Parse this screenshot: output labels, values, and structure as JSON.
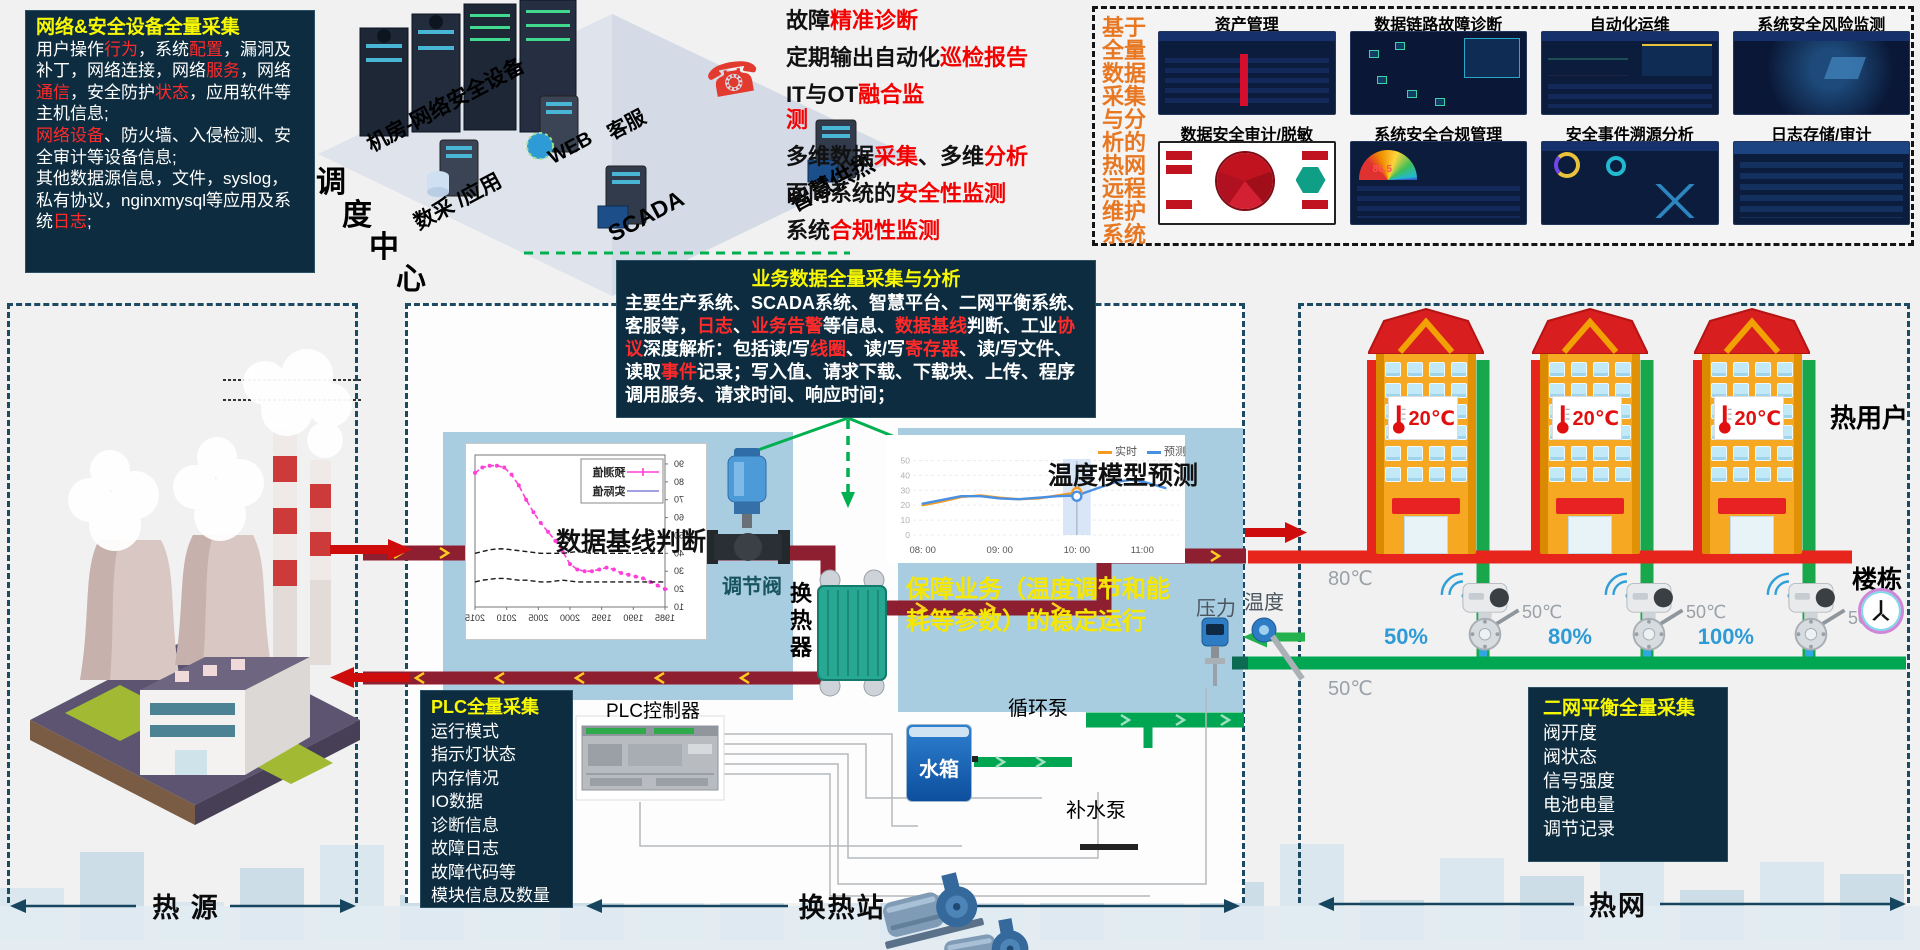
{
  "netbox": {
    "title": "网络&安全设备全量采集",
    "blocks": [
      [
        {
          "t": "用户操作"
        },
        {
          "t": "行为",
          "c": "red"
        },
        {
          "t": "，系统"
        },
        {
          "t": "配置",
          "c": "red"
        },
        {
          "t": "，漏洞及补丁，网络连接，网络"
        },
        {
          "t": "服务",
          "c": "red"
        },
        {
          "t": "，网络"
        },
        {
          "t": "通信",
          "c": "red"
        },
        {
          "t": "，安全防护"
        },
        {
          "t": "状态",
          "c": "red"
        },
        {
          "t": "，应用软件等主机信息;"
        }
      ],
      [
        {
          "t": "网络设备",
          "c": "red"
        },
        {
          "t": "、防火墙、入侵检测、安全审计等设备信息;"
        }
      ],
      [
        {
          "t": "其他数据源信息，文件，syslog，私有协议，nginxmysql等应用及系统"
        },
        {
          "t": "日志",
          "c": "red"
        },
        {
          "t": ";"
        }
      ]
    ]
  },
  "dispatch": {
    "stair": [
      "调",
      "度",
      "中",
      "心"
    ],
    "labels": {
      "machine_room": "机房-网络安全设备",
      "daq": "数采 /应用",
      "web": "WEB",
      "service": "客服",
      "scada": "SCADA",
      "smart_heating": "智慧供热"
    }
  },
  "features": {
    "items": [
      [
        {
          "t": "故障"
        },
        {
          "t": "精准诊断",
          "c": "red"
        }
      ],
      [
        {
          "t": "定期输出自动化"
        },
        {
          "t": "巡检报告",
          "c": "red"
        }
      ],
      [
        {
          "t": "IT与OT"
        },
        {
          "t": "融合监测",
          "c": "red"
        }
      ],
      [
        {
          "t": "多维数据"
        },
        {
          "t": "采集",
          "c": "red"
        },
        {
          "t": "、多维"
        },
        {
          "t": "分析",
          "c": "red"
        }
      ],
      [
        {
          "t": "面向系统的"
        },
        {
          "t": "安全性监测",
          "c": "red"
        }
      ],
      [
        {
          "t": "系统"
        },
        {
          "t": "合规性监测",
          "c": "red"
        }
      ]
    ]
  },
  "remote": {
    "vertical_lines": [
      "基于",
      "全量",
      "数据",
      "采集",
      "与分",
      "析的",
      "热网",
      "远程",
      "维护",
      "系统"
    ],
    "modules": [
      {
        "title": "资产管理"
      },
      {
        "title": "数据链路故障诊断"
      },
      {
        "title": "自动化运维"
      },
      {
        "title": "系统安全风险监测"
      },
      {
        "title": "数据安全审计/脱敏"
      },
      {
        "title": "系统安全合规管理",
        "gauge_value": "86.5"
      },
      {
        "title": "安全事件溯源分析"
      },
      {
        "title": "日志存储/审计"
      }
    ]
  },
  "bizbox": {
    "title": "业务数据全量采集与分析",
    "body": [
      {
        "t": "主要生产系统、SCADA系统、智慧平台、二网平衡系统、客服等，"
      },
      {
        "t": "日志",
        "c": "red"
      },
      {
        "t": "、"
      },
      {
        "t": "业务告警",
        "c": "red"
      },
      {
        "t": "等信息、"
      },
      {
        "t": "数据基线",
        "c": "red"
      },
      {
        "t": "判断、工业"
      },
      {
        "t": "协议",
        "c": "red"
      },
      {
        "t": "深度解析：包括读/写"
      },
      {
        "t": "线圈",
        "c": "red"
      },
      {
        "t": "、读/写"
      },
      {
        "t": "寄存器",
        "c": "red"
      },
      {
        "t": "、读/写文件、读取"
      },
      {
        "t": "事件",
        "c": "red"
      },
      {
        "t": "记录；写入值、请求下载、下载块、上传、程序调用服务、请求时间、响应时间；"
      }
    ]
  },
  "source": {
    "bottom_label": "热 源"
  },
  "station": {
    "plc_panel": {
      "title": "PLC全量采集",
      "items": [
        "运行模式",
        "指示灯状态",
        "内存情况",
        "IO数据",
        "诊断信息",
        "故障日志",
        "故障代码等",
        "模块信息及数量"
      ]
    },
    "plc_label": "PLC控制器",
    "valve_label": "调节阀",
    "exchanger_label_lines": [
      "换",
      "热",
      "器"
    ],
    "tank_label": "水箱",
    "circulation_pump_label": "循环泵",
    "makeup_pump_label": "补水泵",
    "pressure_label": "压力",
    "temperature_label": "温度",
    "assurance_lines": [
      "保障业务（温度调节和能",
      "耗等参数）的稳定运行"
    ],
    "bottom_label": "换热站"
  },
  "network": {
    "users_label": "热用户",
    "building_label": "楼栋",
    "bottom_label": "热网",
    "supply_temp": "80℃",
    "return_temp": "50℃",
    "buildings": [
      {
        "indoor_temp": "20℃"
      },
      {
        "indoor_temp": "20℃"
      },
      {
        "indoor_temp": "20℃"
      }
    ],
    "valves": [
      {
        "opening": "50%",
        "temp": "50℃"
      },
      {
        "opening": "80%",
        "temp": "50℃"
      },
      {
        "opening": "100%",
        "temp": "50℃"
      }
    ],
    "balance_panel": {
      "title": "二网平衡全量采集",
      "items": [
        "阀开度",
        "阀状态",
        "信号强度",
        "电池电量",
        "调节记录"
      ]
    }
  },
  "chart_data": [
    {
      "type": "line",
      "id": "baseline",
      "title_overlay": "数据基线判断",
      "mirrored": true,
      "legend": [
        {
          "name": "预测值",
          "color": "#ff3fd8",
          "marker": "plus"
        },
        {
          "name": "实际值",
          "color": "#8080d8",
          "marker": "none"
        }
      ],
      "x_labels": [
        "2015",
        "2010",
        "2005",
        "2000",
        "1995",
        "1990",
        "1985"
      ],
      "y_labels": [
        90,
        80,
        70,
        60,
        50,
        40,
        30,
        20,
        10
      ],
      "y_range": [
        10,
        95
      ],
      "series": [
        {
          "name": "预测值",
          "style": "dashed-markers",
          "color": "#ff3fd8",
          "values": [
            85,
            88,
            89,
            89,
            88,
            84,
            78,
            70,
            63,
            57,
            52,
            47,
            41,
            34,
            31,
            30,
            30,
            31,
            32,
            31,
            29,
            28,
            27,
            26,
            24,
            22,
            20
          ]
        },
        {
          "name": "基线上限",
          "style": "dashed",
          "color": "#1a1a1a",
          "values": [
            40,
            41,
            42,
            42.5,
            42.5,
            42,
            41.5,
            41,
            40.5,
            40,
            40,
            40,
            40,
            40.5,
            41,
            40.5,
            40,
            40,
            40,
            40,
            40,
            40,
            40,
            40,
            40,
            40,
            40
          ]
        },
        {
          "name": "基线下限",
          "style": "dashed",
          "color": "#1a1a1a",
          "values": [
            24,
            25,
            25.5,
            26,
            26,
            25.5,
            25,
            25,
            24.5,
            24,
            24,
            24.5,
            25,
            24.5,
            24,
            24,
            24,
            24,
            24,
            24,
            24,
            24,
            24,
            24,
            24,
            24,
            24
          ]
        }
      ]
    },
    {
      "type": "line",
      "id": "temp-forecast",
      "title_overlay": "温度模型预测",
      "legend": [
        {
          "name": "实时",
          "color": "#f59a23"
        },
        {
          "name": "预测",
          "color": "#4a90e2"
        }
      ],
      "x_ticks": [
        "08: 00",
        "09: 00",
        "10: 00",
        "11:00"
      ],
      "x_tick_hours": [
        8,
        9,
        10,
        11
      ],
      "y_ticks": [
        0,
        10,
        20,
        30,
        40,
        50
      ],
      "x_range": [
        7.9,
        11.3
      ],
      "y_range": [
        0,
        55
      ],
      "band": [
        9.82,
        10.18
      ],
      "highlight_x": 10,
      "markers": [
        {
          "x": 10,
          "y": 28.5,
          "color": "#f59a23"
        },
        {
          "x": 10,
          "y": 26,
          "color": "#4a90e2"
        }
      ],
      "series": [
        {
          "name": "实时",
          "color": "#f59a23",
          "points": [
            [
              8,
              20
            ],
            [
              8.25,
              22.5
            ],
            [
              8.5,
              25.5
            ],
            [
              8.75,
              26.5
            ],
            [
              9,
              25
            ],
            [
              9.25,
              24
            ],
            [
              9.5,
              24.5
            ],
            [
              9.75,
              26.5
            ],
            [
              10,
              28.5
            ]
          ]
        },
        {
          "name": "预测",
          "color": "#4a90e2",
          "points": [
            [
              8,
              21
            ],
            [
              8.25,
              23.5
            ],
            [
              8.5,
              26
            ],
            [
              8.75,
              26
            ],
            [
              9,
              24.5
            ],
            [
              9.25,
              24
            ],
            [
              9.5,
              25
            ],
            [
              9.75,
              26
            ],
            [
              10,
              26.5
            ],
            [
              10.25,
              31
            ],
            [
              10.5,
              35.5
            ],
            [
              10.7,
              37
            ],
            [
              10.9,
              35.2
            ],
            [
              11.15,
              31.5
            ]
          ]
        }
      ]
    }
  ]
}
